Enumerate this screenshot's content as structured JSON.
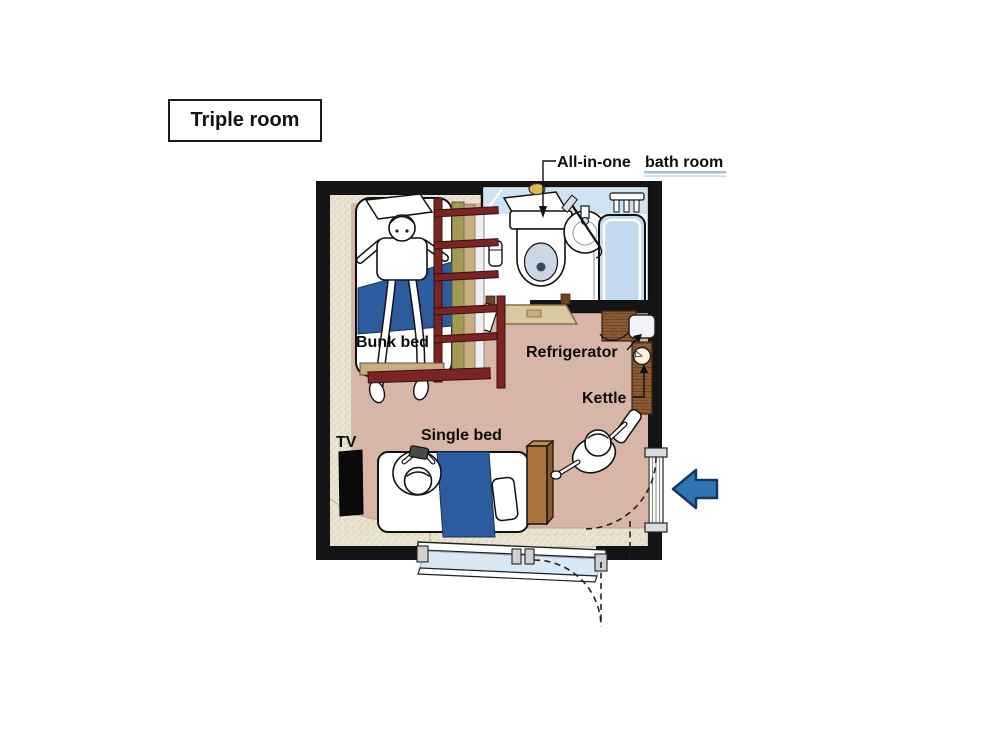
{
  "title_box": {
    "label": "Triple room"
  },
  "plan": {
    "bath_label": {
      "prefix": "All-in-one ",
      "underlined": "bath room"
    },
    "labels": {
      "bunk_bed": "Bunk bed",
      "single_bed": "Single bed",
      "tv": "TV",
      "refrigerator": "Refrigerator",
      "kettle": "Kettle"
    },
    "features": [
      "all-in-one-bathroom",
      "toilet",
      "sink",
      "bathtub",
      "bunk-bed",
      "single-bed",
      "tv",
      "refrigerator",
      "kettle",
      "wall-shelf",
      "entry-door",
      "entrance-arrow",
      "window",
      "door-swing-arcs",
      "person-on-bunk",
      "person-on-single-bed",
      "person-standing"
    ],
    "colors": {
      "floor": "#d7b6a7",
      "wall_black": "#141414",
      "wall_speckle": "#eae3d2",
      "blanket_blue": "#2d5c9e",
      "bath_blue": "#c2d9ef",
      "bath_wall_band": "#cfe2f3",
      "window_glass": "#d9e8f5",
      "wood": "#8a5a33",
      "ladder_maroon": "#7a2424",
      "arrow_blue": "#2e75b6",
      "underline_blue": "#a8c0d8"
    }
  }
}
